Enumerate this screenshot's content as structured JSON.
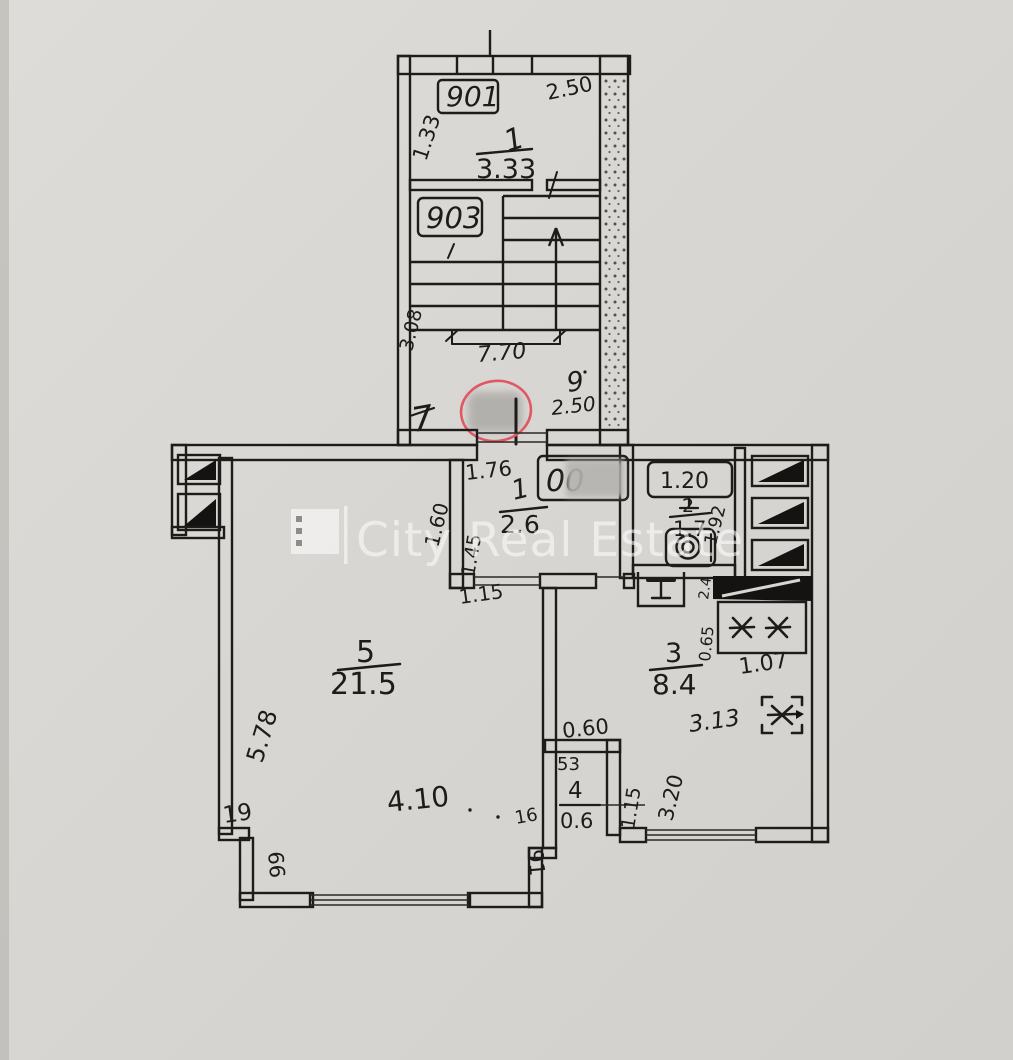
{
  "watermark": {
    "brand": "City Real Estate"
  },
  "stairwell": {
    "unit_top": "901",
    "unit_mid": "903",
    "room_num": "1",
    "room_area": "3.33",
    "dim_width_top": "2.50",
    "dim_left": "1.33",
    "dim_depth": "3.08",
    "dim_width": "7.70",
    "label_left": "7",
    "label_right": "9",
    "dim_landing": "2.50"
  },
  "corridor": {
    "room_num": "1",
    "room_area": "2.6",
    "dim_top": "1.76",
    "dim_left_out": "1.60",
    "dim_left_in": "1.45",
    "dim_bottom": "1.15",
    "unit_partial": "00"
  },
  "bathroom": {
    "room_num": "2",
    "room_area": "1.7",
    "tub_dim": "1.20",
    "dim_right": "1.92"
  },
  "kitchen": {
    "room_num": "3",
    "room_area": "8.4",
    "dim_stove_h": "0.65",
    "dim_stove_w": "1.07",
    "dim_width": "3.13",
    "dim_height": "3.20",
    "dim_niche": "2.4"
  },
  "closet": {
    "room_num": "4",
    "room_area": "0.6",
    "dim_top": "0.60",
    "label_inner": "53",
    "dim_right": "1.15"
  },
  "living": {
    "room_num": "5",
    "room_area": "21.5",
    "dim_left": "5.78",
    "label_left_top": "19",
    "label_left_bottom": "66",
    "dim_bottom": "4.10",
    "label_right_top": "16",
    "label_right_bottom": "91"
  }
}
